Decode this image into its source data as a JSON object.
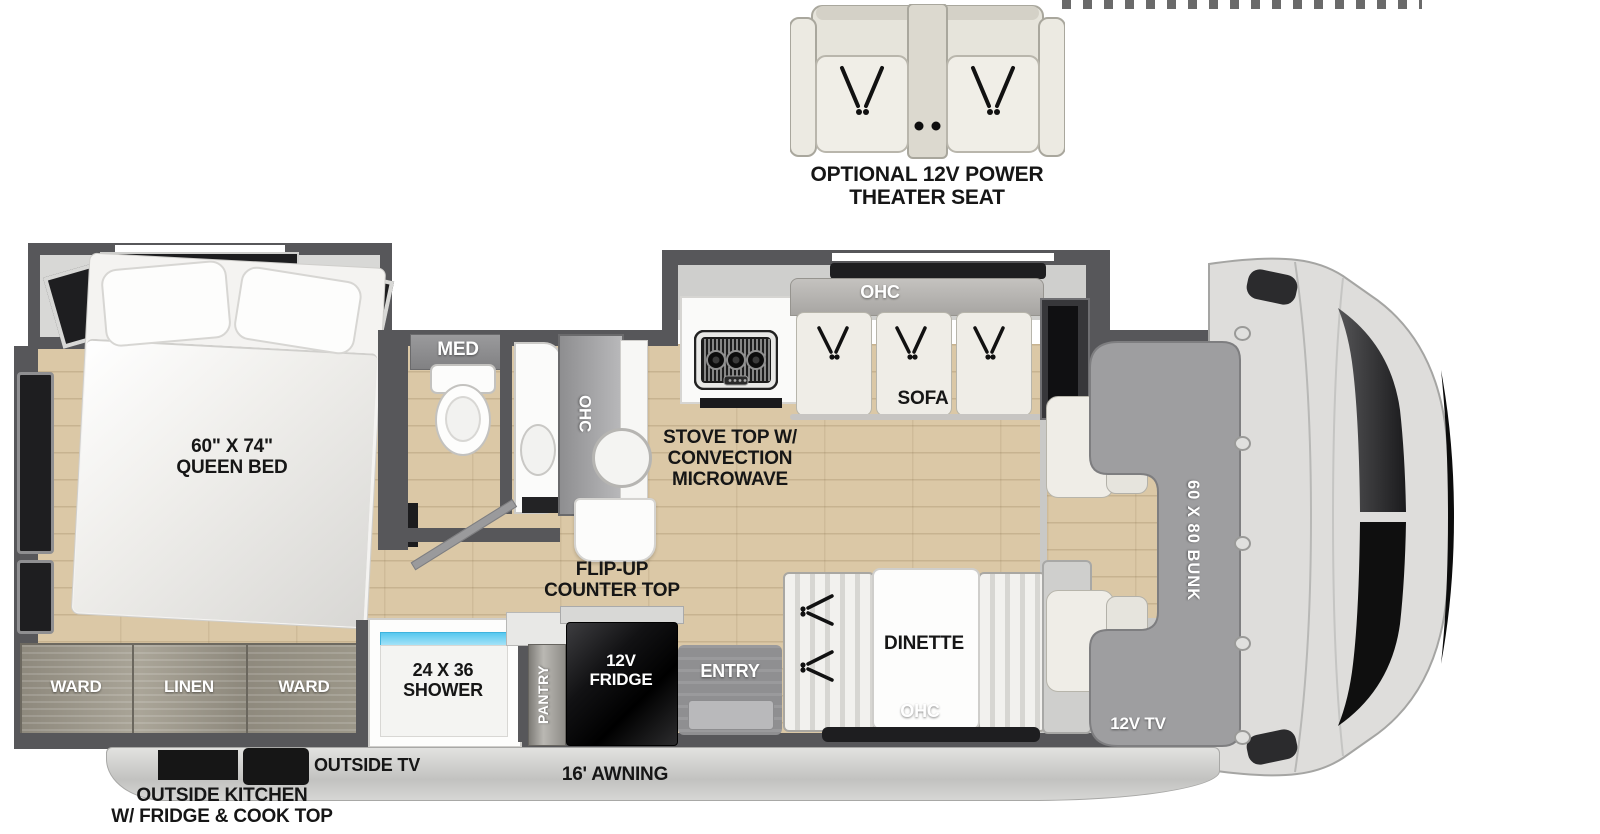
{
  "colors": {
    "wall_gray": "#57575a",
    "floor_tan": "#dbc8a6",
    "shower_glass_blue": "#57c8ef",
    "bunk_gray": "#9e9ea0",
    "label_black": "#161616"
  },
  "theater_option": {
    "line1": "OPTIONAL 12V POWER",
    "line2": "THEATER SEAT"
  },
  "bedroom": {
    "bed_line1": "60\" X 74\"",
    "bed_line2": "QUEEN BED",
    "med": "MED"
  },
  "bathroom": {
    "ohc": "OHC"
  },
  "kitchen": {
    "flip_line1": "FLIP-UP",
    "flip_line2": "COUNTER TOP",
    "stove_line1": "STOVE TOP W/",
    "stove_line2": "CONVECTION",
    "stove_line3": "MICROWAVE"
  },
  "living": {
    "ohc": "OHC",
    "sofa": "SOFA"
  },
  "dinette": {
    "name": "DINETTE",
    "ohc": "OHC"
  },
  "entry": {
    "name": "ENTRY"
  },
  "storage": {
    "ward_left": "WARD",
    "linen": "LINEN",
    "ward_right": "WARD",
    "pantry": "PANTRY"
  },
  "shower": {
    "line1": "24 X 36",
    "line2": "SHOWER"
  },
  "fridge": {
    "line1": "12V",
    "line2": "FRIDGE"
  },
  "front": {
    "bunk": "60 X 80 BUNK",
    "tv": "12V TV"
  },
  "exterior": {
    "outside_tv": "OUTSIDE TV",
    "awning": "16' AWNING",
    "outside_kitchen_line1": "OUTSIDE KITCHEN",
    "outside_kitchen_line2": "W/ FRIDGE & COOK TOP"
  }
}
